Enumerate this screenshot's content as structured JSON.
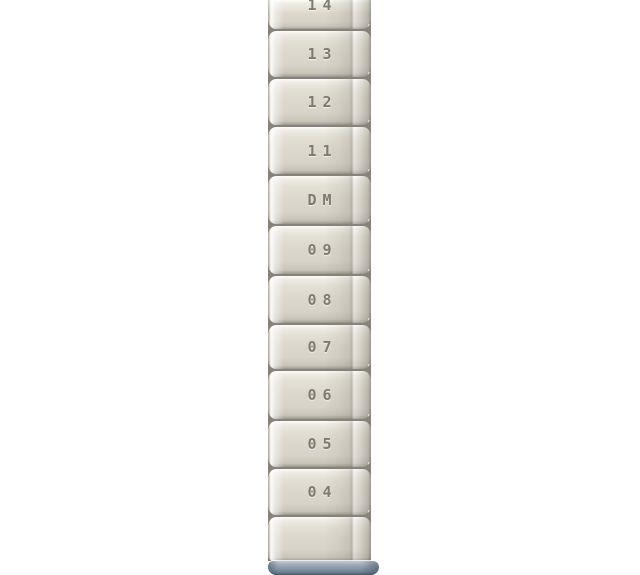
{
  "post": {
    "segments": [
      {
        "label": "14"
      },
      {
        "label": "13"
      },
      {
        "label": "12"
      },
      {
        "label": "11"
      },
      {
        "label": "DM"
      },
      {
        "label": "09"
      },
      {
        "label": "08"
      },
      {
        "label": "07"
      },
      {
        "label": "06"
      },
      {
        "label": "05"
      },
      {
        "label": "04"
      },
      {
        "label": ""
      }
    ],
    "colors": {
      "background": "#ffffff",
      "face": "#dcd8ce",
      "face_highlight": "#f8f7f2",
      "groove": "#87837a",
      "label_text": "#767369",
      "foot_top": "#9fadb9",
      "foot_main": "#8496a5",
      "foot_dark": "#5a6a77"
    }
  }
}
